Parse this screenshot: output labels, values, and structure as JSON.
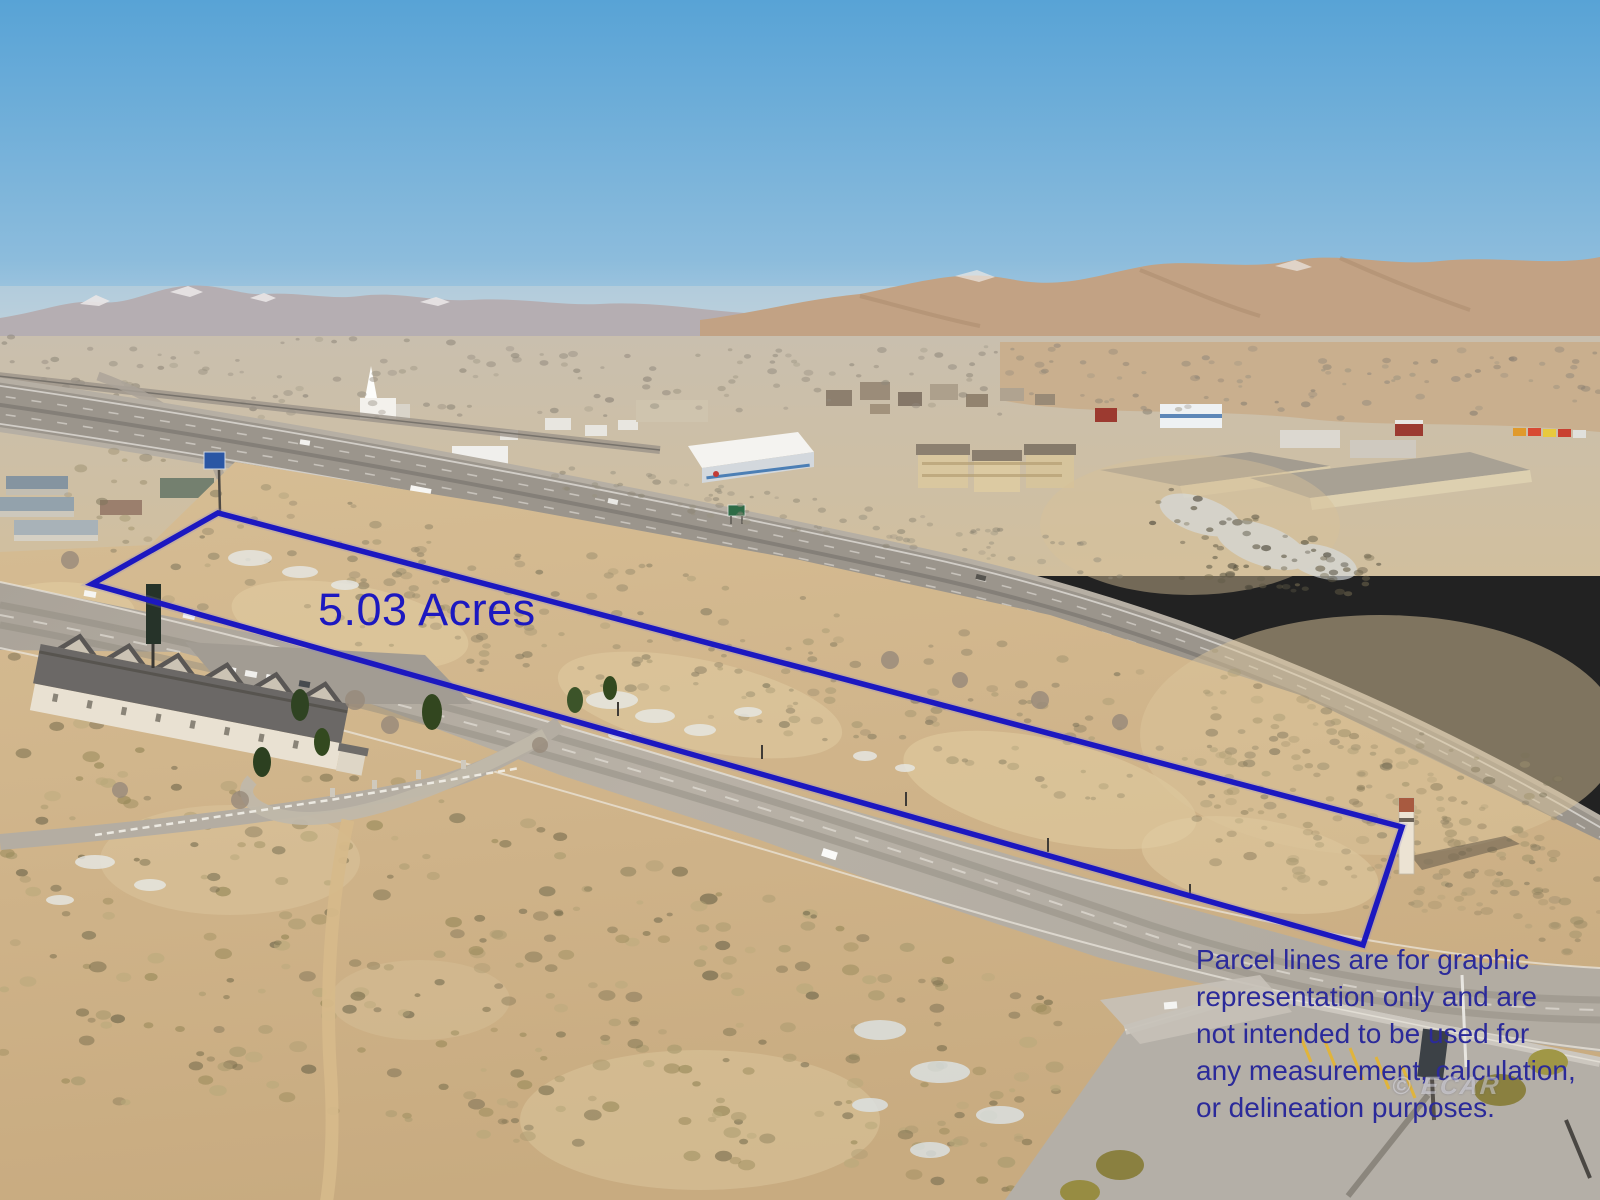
{
  "annotations": {
    "acreage_label": "5.03 Acres",
    "disclaimer_lines": [
      "Parcel lines are for graphic",
      "representation only and are",
      "not intended to be used for",
      "any measurement, calculation,",
      "or delineation purposes."
    ],
    "watermark": "© ECAR"
  },
  "parcel": {
    "points": "92,584 218,513 1402,827 1363,945",
    "outline_color": "#1c18c0"
  },
  "colors": {
    "annotation_blue": "#1c18c0",
    "disclaimer_blue": "#2b2a9a",
    "sky_top": "#58a3d6",
    "sky_horizon": "#a9c9e0",
    "desert_sand": "#d2b88f"
  }
}
